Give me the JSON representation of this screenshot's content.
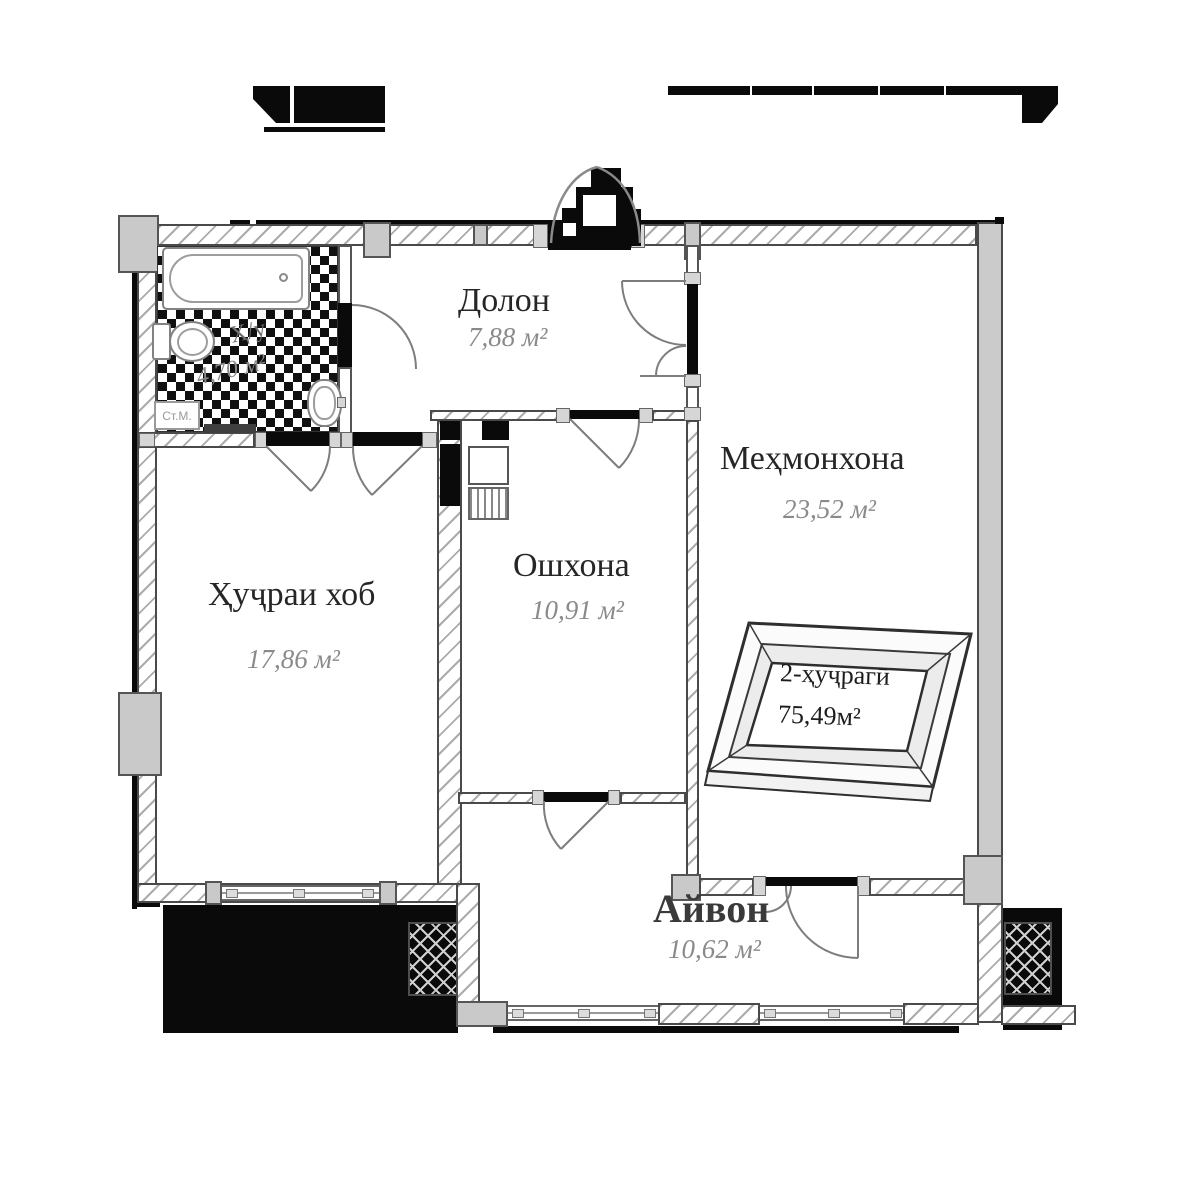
{
  "floorplan": {
    "rooms": [
      {
        "key": "hallway",
        "name": "Долон",
        "area": "7,88 м²"
      },
      {
        "key": "living",
        "name": "Меҳмонхона",
        "area": "23,52 м²"
      },
      {
        "key": "bedroom",
        "name": "Ҳуҷраи хоб",
        "area": "17,86 м²"
      },
      {
        "key": "kitchen",
        "name": "Ошхона",
        "area": "10,91 м²"
      },
      {
        "key": "veranda",
        "name": "Айвон",
        "area": "10,62 м²"
      },
      {
        "key": "bathroom",
        "name": "Ҳ/у",
        "area": "4,70 м²"
      }
    ],
    "stamp": {
      "line1": "2-ҳуҷрагӣ",
      "line2": "75,49м²"
    },
    "labels": {
      "washing_machine": "Ст.М."
    },
    "colors": {
      "wall_outline": "#4a4a4a",
      "pillar_fill": "#c9c9c9",
      "shadow_black": "#0a0a0a",
      "door_arc": "#7d7d7d",
      "text_primary": "#262626",
      "text_secondary": "#8a8a8a"
    }
  }
}
